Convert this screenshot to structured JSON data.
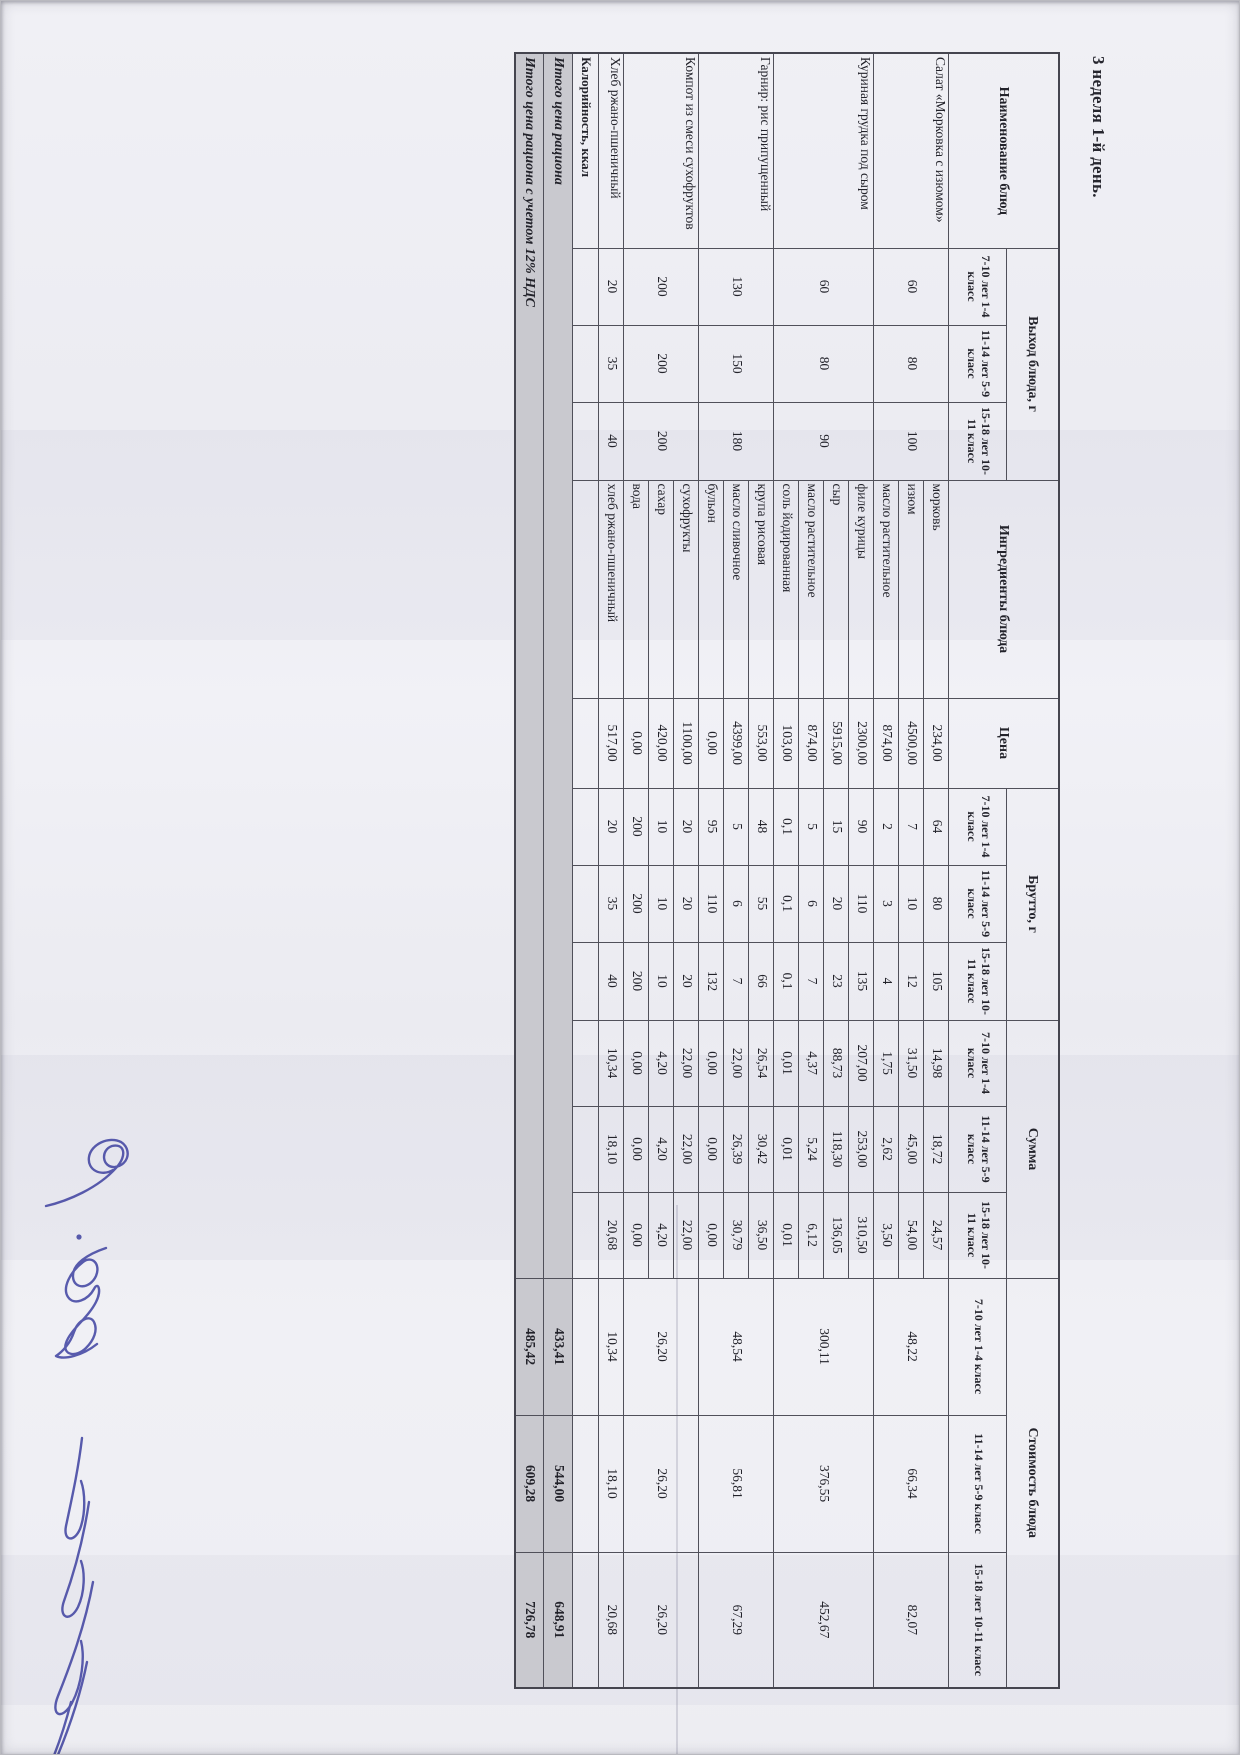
{
  "page": {
    "title": "3 неделя 1-й день."
  },
  "colors": {
    "signature_ink": "#4b4ea6",
    "totals_shading": "#c9c9cf",
    "table_border": "#50505a"
  },
  "table": {
    "headers": {
      "name": "Наименование блюд",
      "yield": "Выход блюда, г",
      "ingredients": "Ингредиенты блюда",
      "price": "Цена",
      "brutto": "Брутто, г",
      "summa": "Сумма",
      "cost": "Стоимость блюда",
      "age_groups": [
        "7-10 лет 1-4 класс",
        "11-14 лет 5-9 класс",
        "15-18 лет 10-11 класс"
      ]
    },
    "dishes": [
      {
        "name": "Салат «Морковка с изюмом»",
        "yield": [
          "60",
          "80",
          "100"
        ],
        "lines": [
          {
            "ingredient": "морковь",
            "price": "234,00",
            "brutto": [
              "64",
              "80",
              "105"
            ],
            "summa": [
              "14,98",
              "18,72",
              "24,57"
            ]
          },
          {
            "ingredient": "изюм",
            "price": "4500,00",
            "brutto": [
              "7",
              "10",
              "12"
            ],
            "summa": [
              "31,50",
              "45,00",
              "54,00"
            ]
          },
          {
            "ingredient": "масло растительное",
            "price": "874,00",
            "brutto": [
              "2",
              "3",
              "4"
            ],
            "summa": [
              "1,75",
              "2,62",
              "3,50"
            ]
          }
        ],
        "cost": [
          "48,22",
          "66,34",
          "82,07"
        ]
      },
      {
        "name": "Куриная грудка под сыром",
        "yield": [
          "60",
          "80",
          "90"
        ],
        "lines": [
          {
            "ingredient": "филе курицы",
            "price": "2300,00",
            "brutto": [
              "90",
              "110",
              "135"
            ],
            "summa": [
              "207,00",
              "253,00",
              "310,50"
            ]
          },
          {
            "ingredient": "сыр",
            "price": "5915,00",
            "brutto": [
              "15",
              "20",
              "23"
            ],
            "summa": [
              "88,73",
              "118,30",
              "136,05"
            ]
          },
          {
            "ingredient": "масло растительное",
            "price": "874,00",
            "brutto": [
              "5",
              "6",
              "7"
            ],
            "summa": [
              "4,37",
              "5,24",
              "6,12"
            ]
          },
          {
            "ingredient": "соль йодированная",
            "price": "103,00",
            "brutto": [
              "0,1",
              "0,1",
              "0,1"
            ],
            "summa": [
              "0,01",
              "0,01",
              "0,01"
            ]
          }
        ],
        "cost": [
          "300,11",
          "376,55",
          "452,67"
        ]
      },
      {
        "name": "Гарнир: рис припущенный",
        "yield": [
          "130",
          "150",
          "180"
        ],
        "lines": [
          {
            "ingredient": "крупа рисовая",
            "price": "553,00",
            "brutto": [
              "48",
              "55",
              "66"
            ],
            "summa": [
              "26,54",
              "30,42",
              "36,50"
            ]
          },
          {
            "ingredient": "масло сливочное",
            "price": "4399,00",
            "brutto": [
              "5",
              "6",
              "7"
            ],
            "summa": [
              "22,00",
              "26,39",
              "30,79"
            ]
          },
          {
            "ingredient": "бульон",
            "price": "0,00",
            "brutto": [
              "95",
              "110",
              "132"
            ],
            "summa": [
              "0,00",
              "0,00",
              "0,00"
            ]
          }
        ],
        "cost": [
          "48,54",
          "56,81",
          "67,29"
        ]
      },
      {
        "name": "Компот из смеси сухофруктов",
        "yield": [
          "200",
          "200",
          "200"
        ],
        "lines": [
          {
            "ingredient": "сухофрукты",
            "price": "1100,00",
            "brutto": [
              "20",
              "20",
              "20"
            ],
            "summa": [
              "22,00",
              "22,00",
              "22,00"
            ]
          },
          {
            "ingredient": "сахар",
            "price": "420,00",
            "brutto": [
              "10",
              "10",
              "10"
            ],
            "summa": [
              "4,20",
              "4,20",
              "4,20"
            ]
          },
          {
            "ingredient": "вода",
            "price": "0,00",
            "brutto": [
              "200",
              "200",
              "200"
            ],
            "summa": [
              "0,00",
              "0,00",
              "0,00"
            ]
          }
        ],
        "cost": [
          "26,20",
          "26,20",
          "26,20"
        ]
      },
      {
        "name": "Хлеб ржано-пшеничный",
        "yield": [
          "20",
          "35",
          "40"
        ],
        "lines": [
          {
            "ingredient": "хлеб ржано-пшеничный",
            "price": "517,00",
            "brutto": [
              "20",
              "35",
              "40"
            ],
            "summa": [
              "10,34",
              "18,10",
              "20,68"
            ]
          }
        ],
        "cost": [
          "10,34",
          "18,10",
          "20,68"
        ]
      }
    ],
    "calories_label": "Калорийность, ккал",
    "totals": [
      {
        "label": "Итого цена рациона",
        "values": [
          "433,41",
          "544,00",
          "648,91"
        ]
      },
      {
        "label": "Итого цена рациона с учетом 12% НДС",
        "values": [
          "485,42",
          "609,28",
          "726,78"
        ]
      }
    ]
  }
}
